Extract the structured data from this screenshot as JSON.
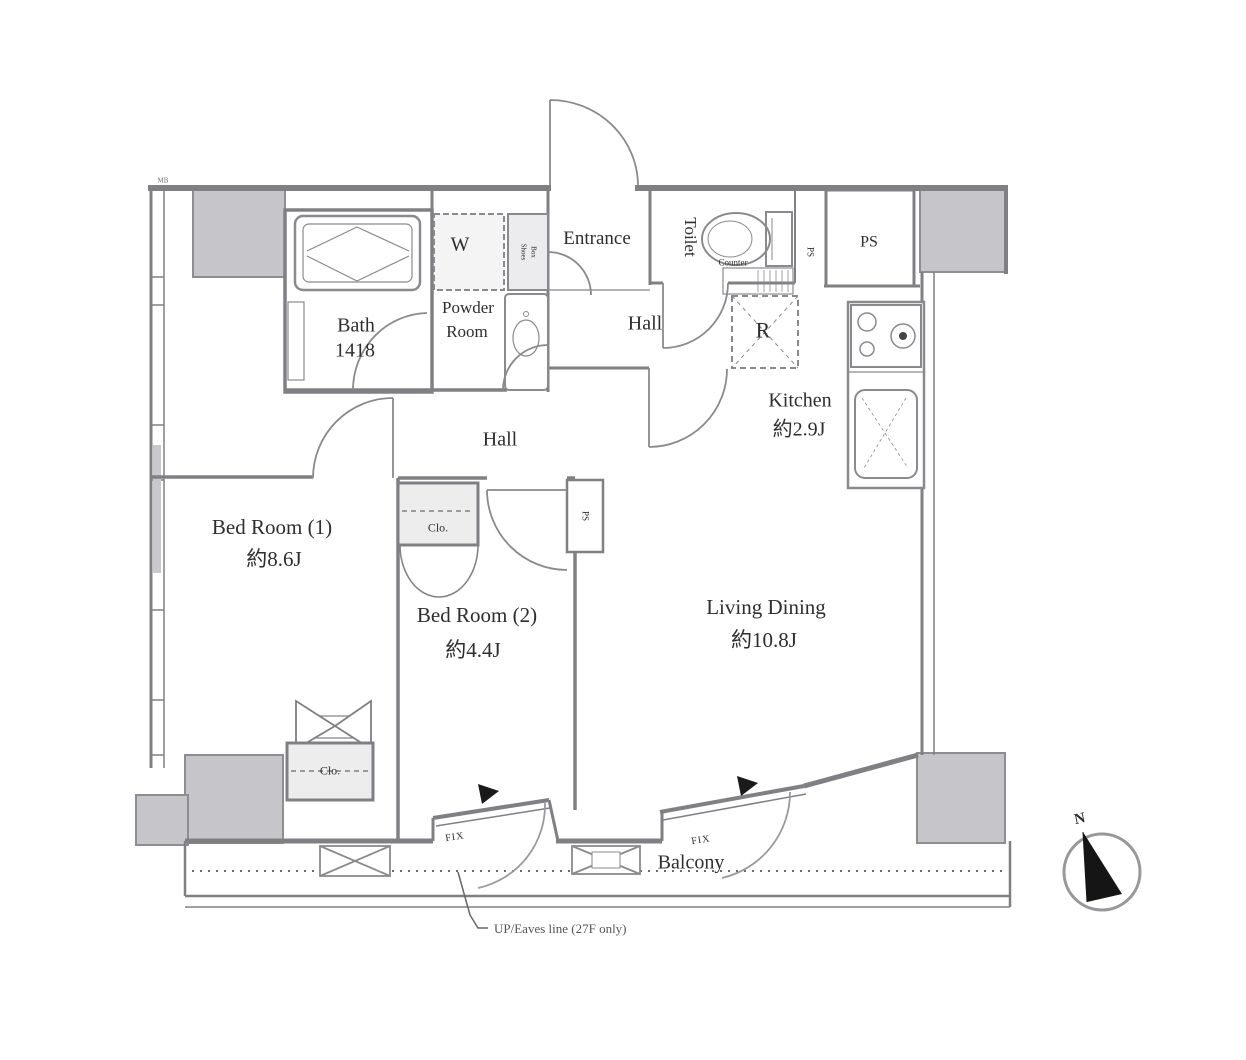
{
  "plan_title": "2LDK apartment floor plan",
  "colors": {
    "wall": "#808084",
    "column_fill": "#c6c6ca",
    "closet_fill": "#ededee",
    "text": "#2e2e2e",
    "needle": "#151515"
  },
  "rooms": {
    "entrance": {
      "label": "Entrance"
    },
    "hall_upper": {
      "label": "Hall"
    },
    "hall_lower": {
      "label": "Hall"
    },
    "toilet": {
      "label": "Toilet"
    },
    "bath": {
      "label": "Bath",
      "size": "1418"
    },
    "powder_room": {
      "line1": "Powder",
      "line2": "Room"
    },
    "kitchen": {
      "label": "Kitchen",
      "size": "約2.9J"
    },
    "bed_room_1": {
      "label": "Bed Room (1)",
      "size": "約8.6J"
    },
    "bed_room_2": {
      "label": "Bed Room (2)",
      "size": "約4.4J"
    },
    "living_dining": {
      "label": "Living Dining",
      "size": "約10.8J"
    },
    "balcony": {
      "label": "Balcony"
    }
  },
  "fixtures": {
    "washer": {
      "label": "W"
    },
    "shoes_box": {
      "line1": "Shoes",
      "line2": "Box"
    },
    "refrigerator": {
      "label": "R"
    },
    "counter": {
      "label": "Counter"
    },
    "closet_bed1": {
      "label": "Clo."
    },
    "closet_bed2": {
      "label": "Clo."
    },
    "ps_top": {
      "label": "PS"
    },
    "ps_toilet": {
      "label": "PS"
    },
    "ps_mid": {
      "label": "PS"
    },
    "meter_box": {
      "label": "MB"
    }
  },
  "windows": {
    "fix_bed2": {
      "label": "FIX"
    },
    "fix_living": {
      "label": "FIX"
    }
  },
  "annotations": {
    "eaves_note": {
      "label": "UP/Eaves line (27F only)"
    }
  },
  "compass": {
    "north": "N"
  }
}
